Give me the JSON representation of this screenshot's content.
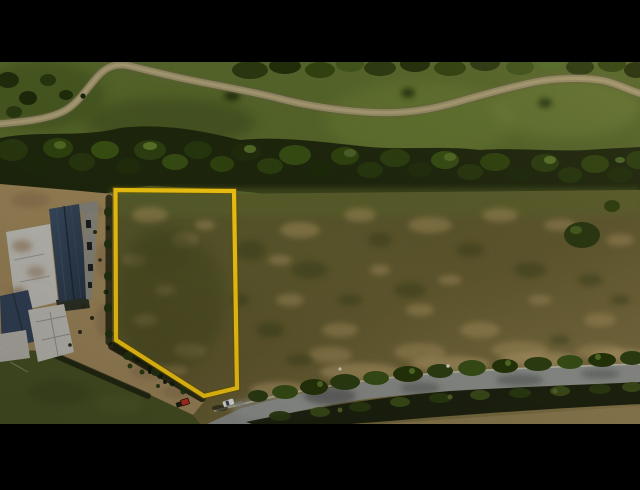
{
  "scene": {
    "type": "aerial-drone-photograph",
    "description": "Top-down aerial photo of a vacant land parcel outlined in yellow; golf-course style lawn with winding walking path and tree line above, house under construction with slate roof at left, mottled brown field, and a tree-lined road with a white car at bottom right. Black letterbox bars top and bottom.",
    "letterbox_color": "#000000",
    "photo_area": {
      "left": 0,
      "top": 62,
      "right": 640,
      "bottom": 424
    }
  },
  "overlay": {
    "plot_boundary": {
      "shape": "polygon",
      "points": "115.5,190 234,191 237,388 204,396 116,340",
      "color": "#ffd013",
      "stroke_width": 4.2
    }
  },
  "landscape": {
    "palette": {
      "lawn_green": "#5b6d2d",
      "tree_band_dark": "#20290e",
      "path_tan": "#a1956e",
      "field_olive": "#615a2e",
      "field_tan_patch": "#a8915f",
      "dirt_tan": "#a28a5c",
      "roof_slate": "#35455a",
      "slab_white": "#c8c6bf",
      "road_gray": "#8f918d",
      "curb_pale": "#c2bdae",
      "grass_dark": "#4a5426"
    }
  },
  "objects": [
    {
      "name": "walking-path",
      "kind": "winding footpath through lawn"
    },
    {
      "name": "tree-band",
      "kind": "dense tree line between lawn and field"
    },
    {
      "name": "plot-boundary",
      "kind": "yellow surveyed parcel outline"
    },
    {
      "name": "construction-house",
      "kind": "house under construction, dark slate roof and concrete slabs"
    },
    {
      "name": "dirt-driveway",
      "kind": "dirt access strip from house to road"
    },
    {
      "name": "road",
      "kind": "paved road crossing bottom right"
    },
    {
      "name": "white-car",
      "kind": "white car parked on road"
    },
    {
      "name": "red-vehicle",
      "kind": "small red vehicle/equipment at driveway entrance"
    }
  ]
}
